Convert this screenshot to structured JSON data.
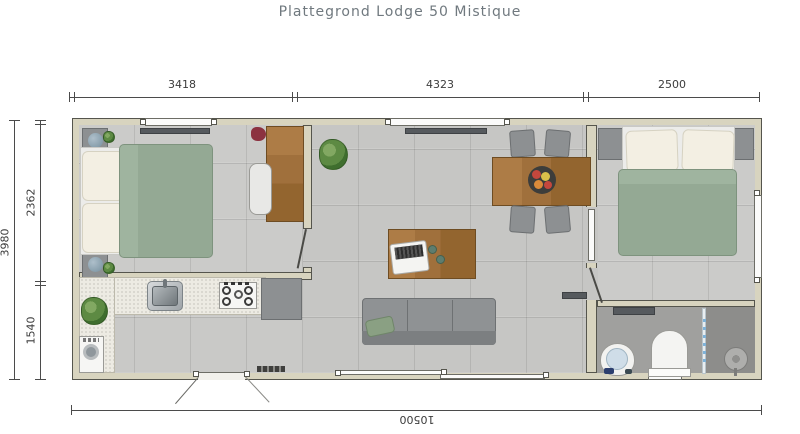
{
  "title": "Plattegrond Lodge 50 Mistique",
  "dimensions": {
    "top": [
      "3418",
      "4323",
      "2500"
    ],
    "left_total": "3980",
    "left_segments": [
      "2362",
      "1540"
    ],
    "bottom_total": "10500"
  },
  "colors": {
    "title_text": "#70797f",
    "dimension_text": "#3c3c3c",
    "wall": "#d8d4bf",
    "floor_tile": "#c7c7c5",
    "duvet_green": "#94a994",
    "wood": "#a0703c",
    "furniture_gray": "#8d9092",
    "counter": "#edebe3",
    "bathroom_floor": "#a0a09e"
  }
}
